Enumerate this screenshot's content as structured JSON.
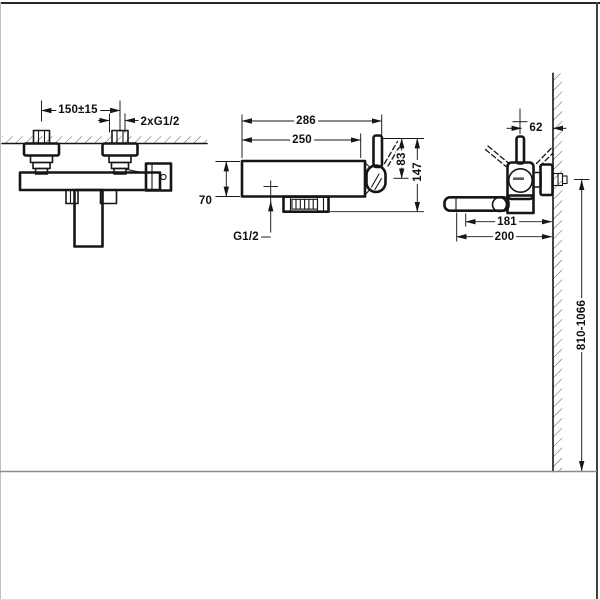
{
  "drawing": {
    "colors": {
      "ink": "#161616",
      "floor_line": "#8a8a8a",
      "background": "#ffffff"
    },
    "front_view": {
      "dims": {
        "inlet_spacing": "150±15",
        "inlet_thread": "2xG1/2"
      }
    },
    "body_view": {
      "dims": {
        "overall_width": "286",
        "body_width": "250",
        "lever_height": "83",
        "overall_height": "147",
        "body_height": "70",
        "shower_outlet": "G1/2"
      }
    },
    "side_view": {
      "dims": {
        "lever_to_wall": "62",
        "outlet_reach": "181",
        "spout_reach": "200",
        "mounting_height": "810-1066"
      }
    }
  }
}
